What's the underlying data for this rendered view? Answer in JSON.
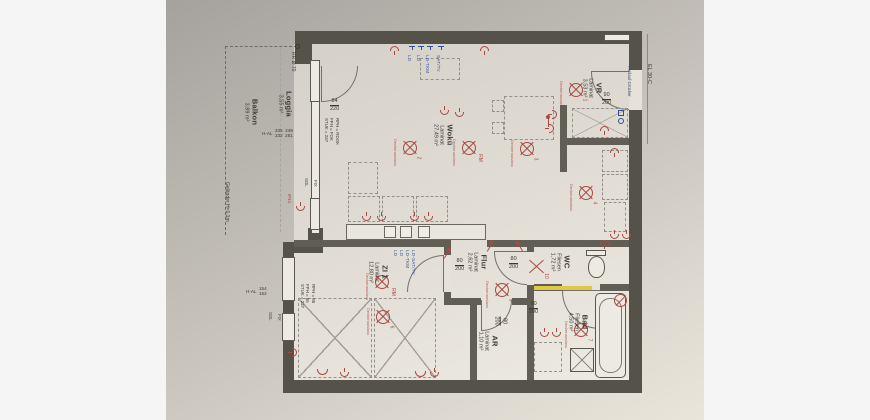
{
  "rooms": {
    "balkon": {
      "name": "Balkon",
      "area": "3,89 m²"
    },
    "loggia": {
      "name": "Loggia",
      "area": "3,55 m²"
    },
    "wokue": {
      "name": "Wokü",
      "floor": "Laminat",
      "area": "27,49 m²"
    },
    "vr": {
      "name": "VR",
      "floor": "Laminat",
      "area": "3,53 m²"
    },
    "wc": {
      "name": "WC",
      "floor": "Fliesen",
      "area": "1,72 m²"
    },
    "bad": {
      "name": "Bad",
      "floor": "Fliesen",
      "area": "4,50 m²"
    },
    "flur": {
      "name": "Flur",
      "floor": "Laminat",
      "area": "2,62 m²"
    },
    "ar": {
      "name": "AR",
      "floor": "Laminat",
      "area": "1,10 m²"
    },
    "zi1": {
      "name": "ZI 1",
      "floor": "Laminat",
      "area": "12,80 m²"
    }
  },
  "doors": {
    "balcony": {
      "w": "84",
      "h": "220"
    },
    "entrance": {
      "w": "90",
      "h": "200",
      "note": "Freilauf-Drücker"
    },
    "wc": {
      "w": "80",
      "h": "200"
    },
    "zi1": {
      "w": "80",
      "h": "200"
    },
    "bad": {
      "w": "80",
      "h": "200"
    },
    "ar": {
      "w": "80",
      "h": "200"
    }
  },
  "windows": {
    "upper": {
      "prefix": "H-AL",
      "c1t": "235",
      "c1b": "232",
      "c2t": "249",
      "c2b": "251",
      "rph": "RPH = RDOK",
      "fph": "FPH = FOK",
      "stuk": "STUK = 237"
    },
    "lower": {
      "prefix": "H-AL",
      "c1t": "154",
      "c1b": "152",
      "rph": "RPH = 85",
      "fph": "FPH = 86",
      "stuk": "STUK = 237"
    },
    "glazing": {
      "sol": "SOL",
      "fix": "FIX"
    }
  },
  "annotations": {
    "rr": "RR Ø 70",
    "gelaender": "Geländer H=1,1m",
    "el": "EL 30-C",
    "ip44": "IP44",
    "deckenauslass": "Deckenauslass"
  },
  "electrical": {
    "lights": [
      {
        "n": "1"
      },
      {
        "n": "2"
      },
      {
        "n": "RM"
      },
      {
        "n": "3"
      },
      {
        "n": "4"
      },
      {
        "n": "5"
      },
      {
        "n": "RM"
      },
      {
        "n": "6"
      },
      {
        "n": "7"
      }
    ],
    "wc_mark": "10"
  },
  "data_outlets": {
    "top": [
      "LD",
      "LD",
      "LD-TKM",
      "SAT/TV"
    ],
    "zi1": [
      "LD",
      "LD",
      "LD-TKM",
      "LD-SAT/TV"
    ]
  },
  "colors": {
    "paper": "#cac6bf",
    "wall": "#55524a",
    "red": "#a84a41",
    "blue": "#31509c",
    "yellow": "#ddca41",
    "margin": "#f5f5f5"
  }
}
